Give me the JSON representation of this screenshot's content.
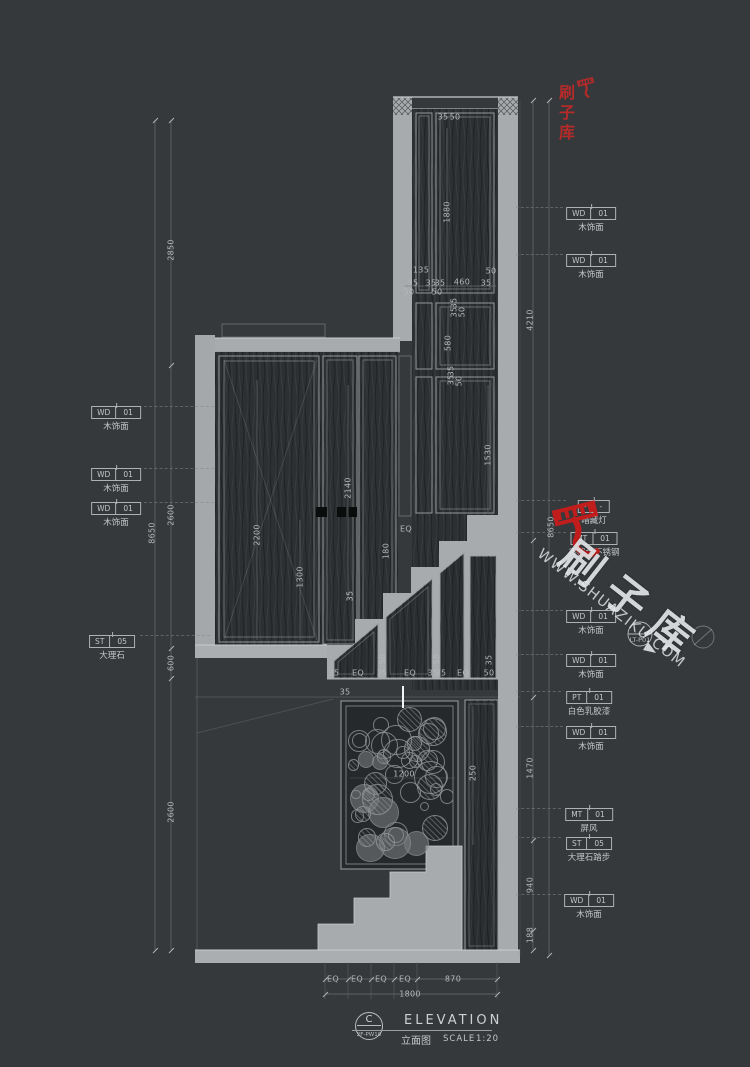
{
  "drawing": {
    "type": "interior-elevation-cad",
    "title_block": {
      "detail_letter": "C",
      "detail_code": "2F-PW10",
      "title": "ELEVATION",
      "title_cn": "立面图",
      "scale_label": "SCALE",
      "scale_value": "1:20"
    },
    "watermark": {
      "brand": "刷子库",
      "site": "WWW.SHUAZIKU.COM"
    },
    "section_marker": {
      "label": "LT-P01"
    },
    "materials_left": [
      {
        "code": "WD",
        "num": "01",
        "name": "木饰面",
        "x": 116,
        "y": 400
      },
      {
        "code": "WD",
        "num": "01",
        "name": "木饰面",
        "x": 116,
        "y": 462
      },
      {
        "code": "WD",
        "num": "01",
        "name": "木饰面",
        "x": 116,
        "y": 496
      },
      {
        "code": "ST",
        "num": "05",
        "name": "大理石",
        "x": 112,
        "y": 629
      }
    ],
    "materials_right": [
      {
        "code": "WD",
        "num": "01",
        "name": "木饰面",
        "x": 591,
        "y": 201
      },
      {
        "code": "WD",
        "num": "01",
        "name": "木饰面",
        "x": 591,
        "y": 248
      },
      {
        "code": "-",
        "num": "-",
        "name": "暗藏灯",
        "x": 594,
        "y": 494
      },
      {
        "code": "MT",
        "num": "01",
        "name": "香槟金不锈钢",
        "x": 594,
        "y": 526
      },
      {
        "code": "WD",
        "num": "01",
        "name": "木饰面",
        "x": 591,
        "y": 604
      },
      {
        "code": "WD",
        "num": "01",
        "name": "木饰面",
        "x": 591,
        "y": 648
      },
      {
        "code": "PT",
        "num": "01",
        "name": "白色乳胶漆",
        "x": 589,
        "y": 685
      },
      {
        "code": "WD",
        "num": "01",
        "name": "木饰面",
        "x": 591,
        "y": 720
      },
      {
        "code": "MT",
        "num": "01",
        "name": "屏风",
        "x": 589,
        "y": 802
      },
      {
        "code": "ST",
        "num": "05",
        "name": "大理石踏步",
        "x": 589,
        "y": 831
      },
      {
        "code": "WD",
        "num": "01",
        "name": "木饰面",
        "x": 589,
        "y": 888
      }
    ],
    "dimensions": [
      {
        "v": "2850",
        "x": 171,
        "y": 250,
        "rot": 1
      },
      {
        "v": "8650",
        "x": 152,
        "y": 533,
        "rot": 1
      },
      {
        "v": "2600",
        "x": 171,
        "y": 515,
        "rot": 1
      },
      {
        "v": "600",
        "x": 171,
        "y": 663,
        "rot": 1
      },
      {
        "v": "2600",
        "x": 171,
        "y": 812,
        "rot": 1
      },
      {
        "v": "4210",
        "x": 530,
        "y": 320,
        "rot": 1
      },
      {
        "v": "8650",
        "x": 551,
        "y": 527,
        "rot": 1
      },
      {
        "v": "1470",
        "x": 530,
        "y": 768,
        "rot": 1
      },
      {
        "v": "940",
        "x": 530,
        "y": 885,
        "rot": 1
      },
      {
        "v": "188",
        "x": 530,
        "y": 935,
        "rot": 1
      },
      {
        "v": "1880",
        "x": 447,
        "y": 212,
        "rot": 1
      },
      {
        "v": "35",
        "x": 443,
        "y": 117
      },
      {
        "v": "50",
        "x": 455,
        "y": 117
      },
      {
        "v": "135",
        "x": 421,
        "y": 270
      },
      {
        "v": "35",
        "x": 413,
        "y": 283
      },
      {
        "v": "35",
        "x": 431,
        "y": 283
      },
      {
        "v": "35",
        "x": 440,
        "y": 283
      },
      {
        "v": "460",
        "x": 462,
        "y": 282
      },
      {
        "v": "35",
        "x": 486,
        "y": 283
      },
      {
        "v": "50",
        "x": 491,
        "y": 271
      },
      {
        "v": "50",
        "x": 409,
        "y": 292
      },
      {
        "v": "50",
        "x": 437,
        "y": 292
      },
      {
        "v": "35",
        "x": 454,
        "y": 303,
        "rot": 1
      },
      {
        "v": "35",
        "x": 454,
        "y": 312,
        "rot": 1
      },
      {
        "v": "50",
        "x": 462,
        "y": 312,
        "rot": 1
      },
      {
        "v": "580",
        "x": 448,
        "y": 343,
        "rot": 1
      },
      {
        "v": "35",
        "x": 451,
        "y": 371,
        "rot": 1
      },
      {
        "v": "35",
        "x": 451,
        "y": 380,
        "rot": 1
      },
      {
        "v": "50",
        "x": 459,
        "y": 381,
        "rot": 1
      },
      {
        "v": "1530",
        "x": 488,
        "y": 455,
        "rot": 1
      },
      {
        "v": "2200",
        "x": 257,
        "y": 535,
        "rot": 1
      },
      {
        "v": "2140",
        "x": 348,
        "y": 488,
        "rot": 1
      },
      {
        "v": "1300",
        "x": 300,
        "y": 577,
        "rot": 1
      },
      {
        "v": "35",
        "x": 350,
        "y": 596,
        "rot": 1
      },
      {
        "v": "EQ",
        "x": 406,
        "y": 529
      },
      {
        "v": "180",
        "x": 386,
        "y": 551,
        "rot": 1
      },
      {
        "v": "50",
        "x": 383,
        "y": 659,
        "rot": 1
      },
      {
        "v": "50",
        "x": 437,
        "y": 659,
        "rot": 1
      },
      {
        "v": "35",
        "x": 489,
        "y": 660,
        "rot": 1
      },
      {
        "v": "35",
        "x": 334,
        "y": 673
      },
      {
        "v": "EQ",
        "x": 358,
        "y": 673
      },
      {
        "v": "35",
        "x": 382,
        "y": 673
      },
      {
        "v": "EQ",
        "x": 410,
        "y": 673
      },
      {
        "v": "35",
        "x": 433,
        "y": 673
      },
      {
        "v": "35",
        "x": 441,
        "y": 673
      },
      {
        "v": "EQ",
        "x": 463,
        "y": 673
      },
      {
        "v": "50",
        "x": 489,
        "y": 673
      },
      {
        "v": "35",
        "x": 345,
        "y": 692
      },
      {
        "v": "1200",
        "x": 404,
        "y": 774
      },
      {
        "v": "250",
        "x": 473,
        "y": 773,
        "rot": 1
      },
      {
        "v": "EQ",
        "x": 333,
        "y": 979
      },
      {
        "v": "EQ",
        "x": 357,
        "y": 979
      },
      {
        "v": "EQ",
        "x": 381,
        "y": 979
      },
      {
        "v": "EQ",
        "x": 405,
        "y": 979
      },
      {
        "v": "870",
        "x": 453,
        "y": 979
      },
      {
        "v": "1800",
        "x": 410,
        "y": 994
      }
    ]
  }
}
